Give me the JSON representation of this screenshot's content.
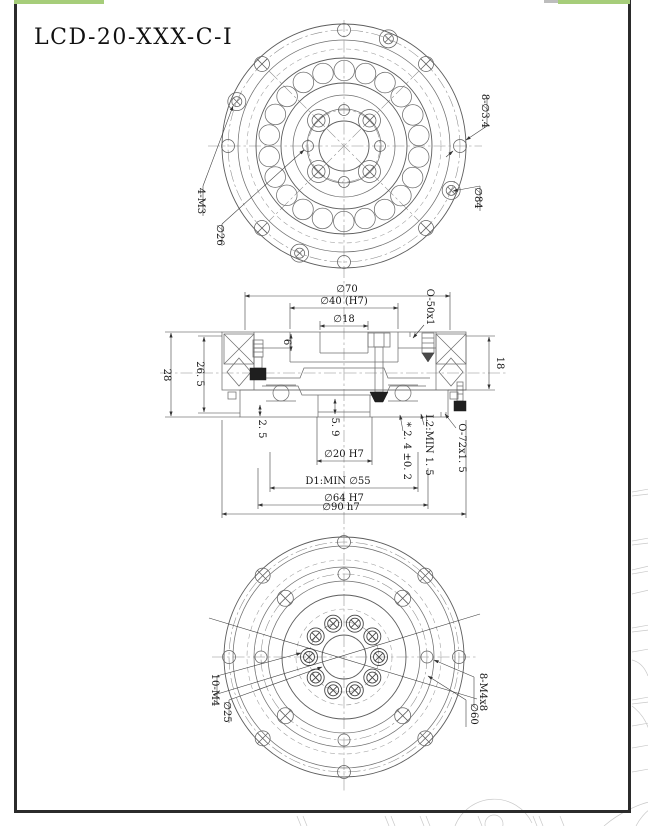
{
  "title": "LCD-20-XXX-C-I",
  "colors": {
    "corner_highlight_green": "#a6cd7a",
    "frame_black": "#2b2b2b",
    "line_gray": "#6f6f6f"
  },
  "top_view": {
    "label_4m3": "4-M3",
    "label_d26": "∅26",
    "label_8d34": "8-∅3.4",
    "label_d84": "∅84"
  },
  "section_view": {
    "d70": "∅70",
    "d40": "∅40 (H7)",
    "d18": "∅18",
    "d6": "6",
    "oring_top": "O-50x1",
    "h28": "28",
    "h265": "26. 5",
    "h18": "18",
    "h25": "2. 5",
    "h59": "5. 9",
    "d20": "∅20 H7",
    "tol": "* 2. 4 ±0. 2",
    "l2": "L2:MIN 1. 5",
    "oring_bot": "O-72x1. 5",
    "d1": "D1:MIN ∅55",
    "d64": "∅64 H7",
    "d90": "∅90 h7"
  },
  "bottom_view": {
    "label_10m4": "10-M4",
    "label_d25": "∅25",
    "label_8m4x8": "8-M4x8",
    "label_d60": "∅60"
  }
}
